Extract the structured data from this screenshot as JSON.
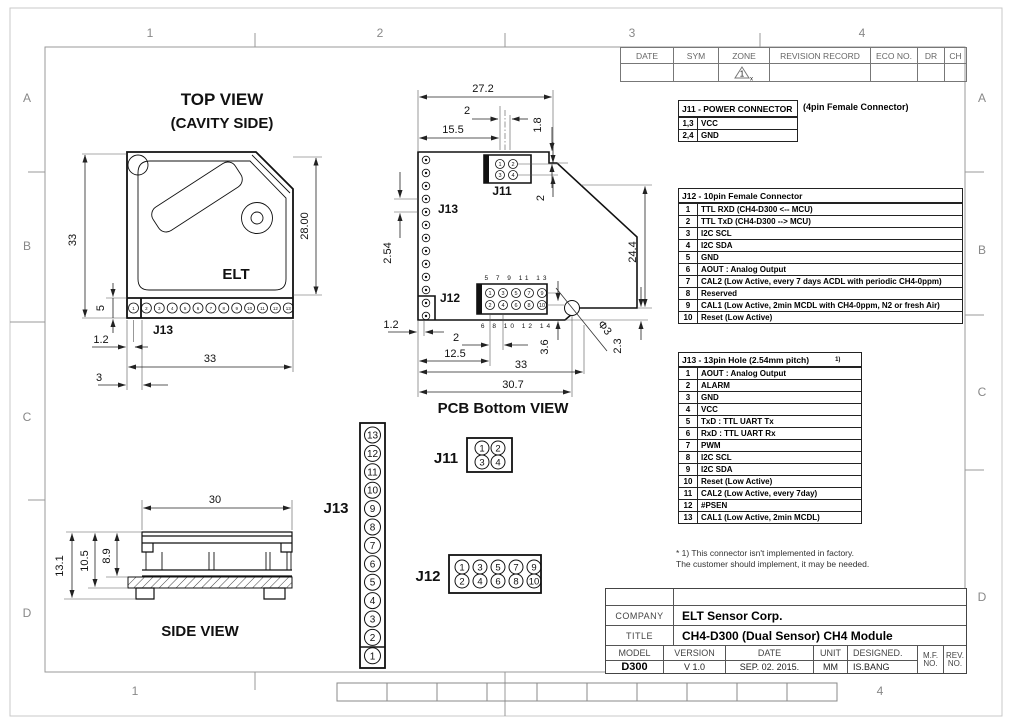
{
  "sheet": {
    "zone_cols": [
      "1",
      "2",
      "3",
      "4"
    ],
    "zone_rows": [
      "A",
      "B",
      "C",
      "D"
    ]
  },
  "revision_table": {
    "headers": [
      "DATE",
      "SYM",
      "ZONE",
      "REVISION RECORD",
      "ECO NO.",
      "DR",
      "CH"
    ],
    "zone_mark": {
      "num": "1",
      "sub": "x"
    }
  },
  "top_view": {
    "title1": "TOP VIEW",
    "title2": "(CAVITY SIDE)",
    "elt": "ELT",
    "j13": "J13",
    "d_h33": "33",
    "d_h28": "28.00",
    "d_h5": "5",
    "d_1_2": "1.2",
    "d_w33": "33",
    "d_3": "3"
  },
  "pcb": {
    "title": "PCB Bottom VIEW",
    "j11": "J11",
    "j12": "J12",
    "j13": "J13",
    "d27_2": "27.2",
    "d2a": "2",
    "d15_5": "15.5",
    "d1_8": "1.8",
    "d2b": "2",
    "d2_54": "2.54",
    "d24_4": "24.4",
    "d1_2": "1.2",
    "d2c": "2",
    "d12_5": "12.5",
    "d33": "33",
    "d3_6": "3.6",
    "d30_7": "30.7",
    "d2_3": "2.3",
    "dphi": "Φ3",
    "ext_top": "5 7 9 11 13",
    "ext_bot": "6 8 10 12 14"
  },
  "side": {
    "title": "SIDE VIEW",
    "d30": "30",
    "d13_1": "13.1",
    "d10_5": "10.5",
    "d8_9": "8.9"
  },
  "diagrams": {
    "j11": "J11",
    "j12": "J12",
    "j13": "J13"
  },
  "pins": {
    "n": [
      "1",
      "2",
      "3",
      "4",
      "5",
      "6",
      "7",
      "8",
      "9",
      "10",
      "11",
      "12",
      "13"
    ],
    "j12_top": [
      "1",
      "3",
      "5",
      "7",
      "9"
    ],
    "j12_bot": [
      "2",
      "4",
      "6",
      "8",
      "10"
    ]
  },
  "j11_table": {
    "title": "J11 - POWER CONNECTOR",
    "note": "(4pin Female Connector)",
    "rows": [
      [
        "1,3",
        "VCC"
      ],
      [
        "2,4",
        "GND"
      ]
    ]
  },
  "j12_table": {
    "title": "J12 - 10pin Female Connector",
    "rows": [
      [
        "1",
        "TTL RXD (CH4-D300 <-- MCU)"
      ],
      [
        "2",
        "TTL TxD (CH4-D300 --> MCU)"
      ],
      [
        "3",
        "I2C SCL"
      ],
      [
        "4",
        "I2C SDA"
      ],
      [
        "5",
        "GND"
      ],
      [
        "6",
        "AOUT : Analog Output"
      ],
      [
        "7",
        "CAL2 (Low Active, every 7 days ACDL with periodic CH4-0ppm)"
      ],
      [
        "8",
        "Reserved"
      ],
      [
        "9",
        "CAL1 (Low Active, 2min MCDL with CH4-0ppm, N2 or fresh Air)"
      ],
      [
        "10",
        "Reset (Low Active)"
      ]
    ]
  },
  "j13_table": {
    "title": "J13 - 13pin Hole (2.54mm pitch)",
    "title_sup": "1)",
    "rows": [
      [
        "1",
        "AOUT : Analog Output"
      ],
      [
        "2",
        "ALARM"
      ],
      [
        "3",
        "GND"
      ],
      [
        "4",
        "VCC"
      ],
      [
        "5",
        "TxD : TTL UART Tx"
      ],
      [
        "6",
        "RxD : TTL UART Rx"
      ],
      [
        "7",
        "PWM"
      ],
      [
        "8",
        "I2C SCL"
      ],
      [
        "9",
        "I2C SDA"
      ],
      [
        "10",
        "Reset (Low Active)"
      ],
      [
        "11",
        "CAL2 (Low Active, every 7day)"
      ],
      [
        "12",
        "#PSEN"
      ],
      [
        "13",
        "CAL1 (Low Active, 2min MCDL)"
      ]
    ],
    "footnote1": "* 1) This connector isn't implemented in factory.",
    "footnote2": "The customer should implement, it may be needed."
  },
  "title_block": {
    "company_label": "COMPANY",
    "company": "ELT Sensor Corp.",
    "title_label": "TITLE",
    "title": "CH4-D300 (Dual Sensor) CH4 Module",
    "model_label": "MODEL",
    "version_label": "VERSION",
    "date_label": "DATE",
    "unit_label": "UNIT",
    "designed_label": "DESIGNED.",
    "mf1": "M.F.",
    "mf2": "NO.",
    "rev1": "REV.",
    "rev2": "NO.",
    "model": "D300",
    "version": "V 1.0",
    "date": "SEP. 02. 2015.",
    "unit": "MM",
    "designed": "IS.BANG"
  }
}
